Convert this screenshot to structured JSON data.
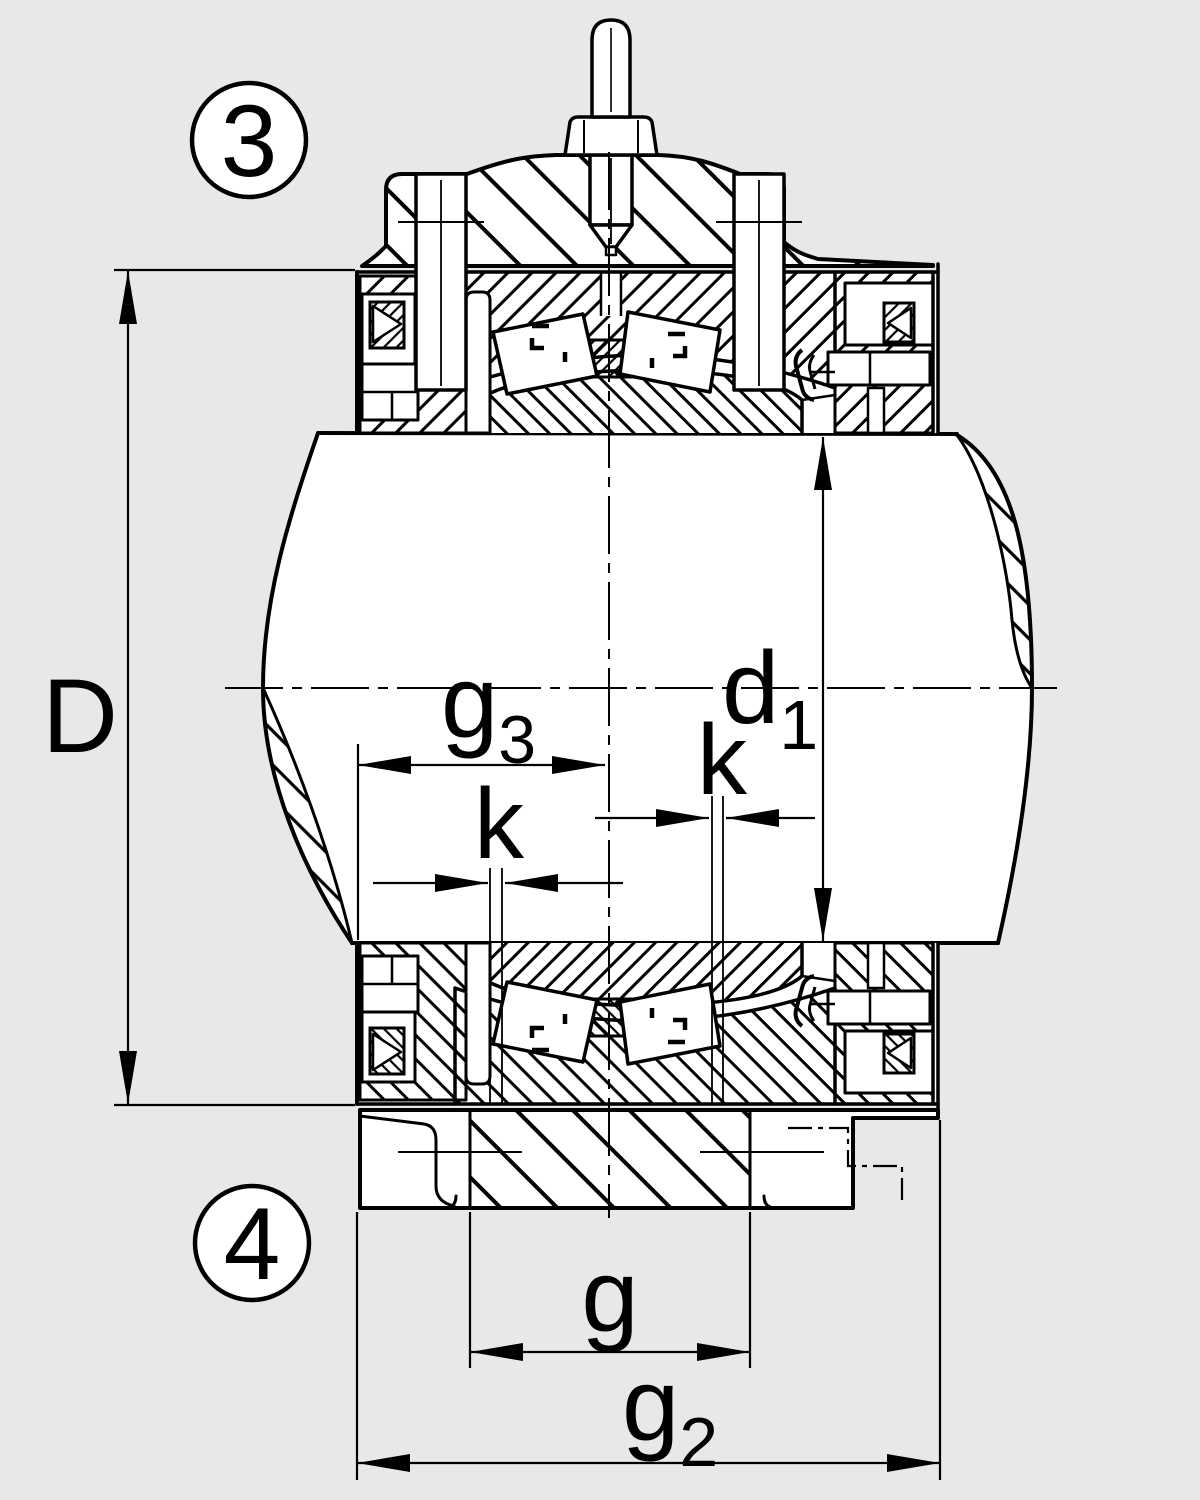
{
  "figure": {
    "type": "technical-sectional-drawing",
    "subject": "split plummer block bearing housing with double-row bearing, shaft and lubrication nipple"
  },
  "colors": {
    "background": "#e8e8e8",
    "line": "#000000",
    "metal_fill": "#ffffff"
  },
  "callouts": [
    {
      "label": "3"
    },
    {
      "label": "4"
    }
  ],
  "dimensions": {
    "D": {
      "label": "D"
    },
    "d1": {
      "main": "d",
      "sub": "1"
    },
    "g3": {
      "main": "g",
      "sub": "3"
    },
    "k_left": {
      "label": "k"
    },
    "k_right": {
      "label": "k"
    },
    "g": {
      "label": "g"
    },
    "g2": {
      "main": "g",
      "sub": "2"
    }
  }
}
